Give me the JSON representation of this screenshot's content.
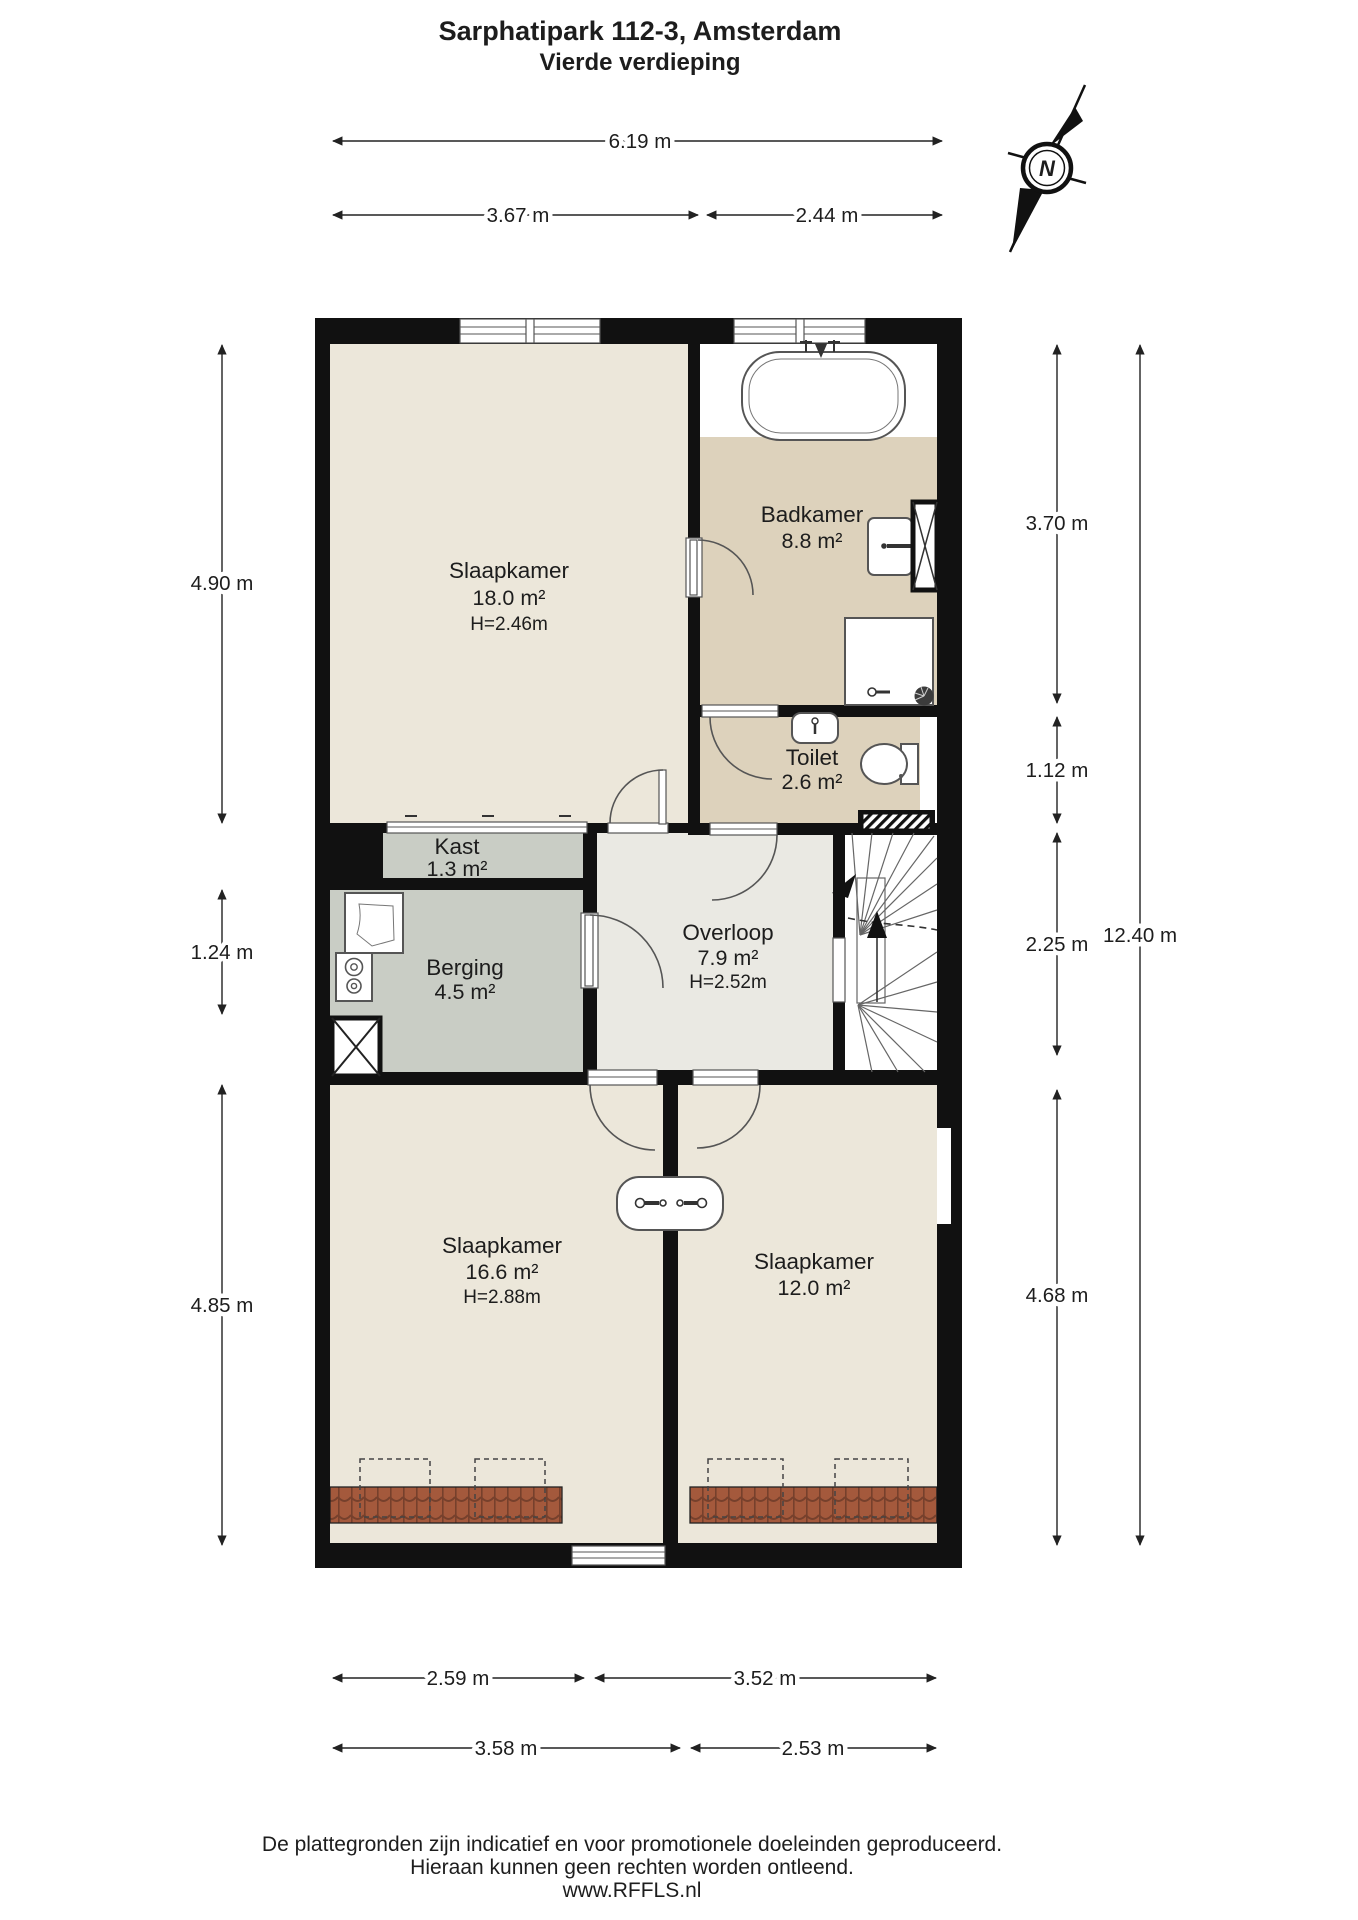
{
  "title": {
    "line1": "Sarphatipark 112-3, Amsterdam",
    "line2": "Vierde verdieping"
  },
  "compass": {
    "label": "N"
  },
  "rooms": {
    "slaapkamer1": {
      "name": "Slaapkamer",
      "area": "18.0 m²",
      "ceiling": "H=2.46m"
    },
    "badkamer": {
      "name": "Badkamer",
      "area": "8.8 m²"
    },
    "toilet": {
      "name": "Toilet",
      "area": "2.6 m²"
    },
    "kast": {
      "name": "Kast",
      "area": "1.3 m²"
    },
    "berging": {
      "name": "Berging",
      "area": "4.5 m²"
    },
    "overloop": {
      "name": "Overloop",
      "area": "7.9 m²",
      "ceiling": "H=2.52m"
    },
    "slaapkamer2": {
      "name": "Slaapkamer",
      "area": "16.6 m²",
      "ceiling": "H=2.88m"
    },
    "slaapkamer3": {
      "name": "Slaapkamer",
      "area": "12.0 m²"
    }
  },
  "dimensions": {
    "top": [
      {
        "label": "6.19 m"
      },
      {
        "label": "3.67 m"
      },
      {
        "label": "2.44 m"
      }
    ],
    "left": [
      {
        "label": "4.90 m"
      },
      {
        "label": "1.24 m"
      },
      {
        "label": "4.85 m"
      }
    ],
    "right": [
      {
        "label": "3.70 m"
      },
      {
        "label": "1.12 m"
      },
      {
        "label": "2.25 m"
      },
      {
        "label": "4.68 m"
      },
      {
        "label": "12.40 m"
      }
    ],
    "bottom": [
      {
        "label": "2.59 m"
      },
      {
        "label": "3.52 m"
      },
      {
        "label": "3.58 m"
      },
      {
        "label": "2.53 m"
      }
    ]
  },
  "footer": {
    "line1": "De plattegronden zijn indicatief en voor promotionele doeleinden geproduceerd.",
    "line2": "Hieraan kunnen geen rechten worden ontleend.",
    "line3": "www.RFFLS.nl"
  },
  "colors": {
    "wall": "#111111",
    "bedroom_floor": "#ECE7DA",
    "bathroom_floor": "#DDD2BC",
    "storage_floor": "#C9CDC5",
    "hall_floor": "#EAE9E3",
    "roof_tiles": "#A4593C",
    "dimension_text": "#1d1d1d"
  }
}
